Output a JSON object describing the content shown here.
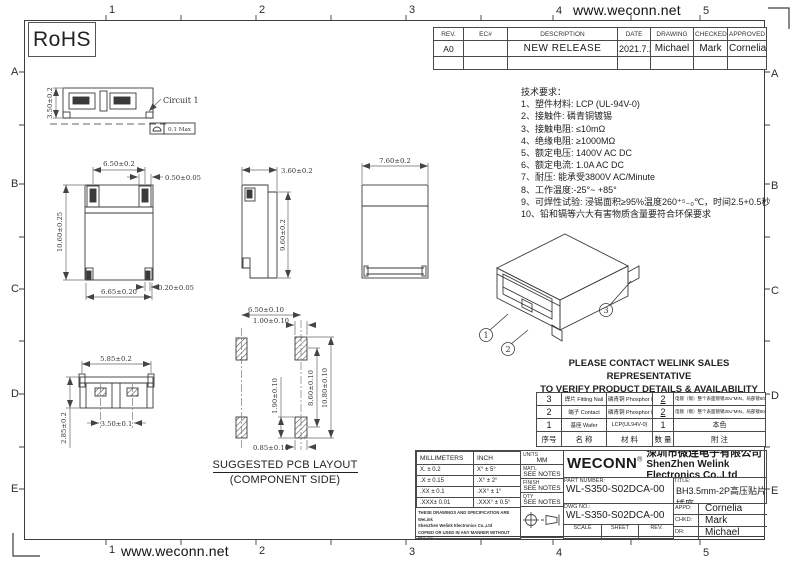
{
  "sheet": {
    "top_url": "www.weconn.net",
    "bottom_url": "www.weconn.net",
    "rohs_label": "RoHS",
    "grid_cols": [
      "1",
      "2",
      "3",
      "4",
      "5"
    ],
    "grid_rows": [
      "A",
      "B",
      "C",
      "D",
      "E"
    ]
  },
  "revision_table": {
    "headers": [
      "REV.",
      "EC#",
      "DESCRIPTION",
      "DATE",
      "DRAWING",
      "CHECKED",
      "APPROVED"
    ],
    "row": {
      "rev": "A0",
      "ec": "",
      "description": "NEW RELEASE",
      "date": "2021.7.25",
      "drawing": "Michael",
      "checked": "Mark",
      "approved": "Cornelia"
    }
  },
  "tech_notes": {
    "title": "技术要求：",
    "items": [
      "1、塑件材料: LCP (UL-94V-0)",
      "2、接触件: 磷青铜镀锡",
      "3、接触电阻: ≤10mΩ",
      "4、绝缘电阻: ≥1000MΩ",
      "5、额定电压: 1400V AC DC",
      "6、额定电流: 1.0A AC DC",
      "7、耐压: 能承受3800V  AC/Minute",
      "8、工作温度:-25°~ +85°",
      "9、可焊性试验: 浸锡面积≥95%温度260⁺⁵₋₀℃，时间2.5+0.5秒",
      "10、铅和镉等六大有害物质含量要符合环保要求"
    ]
  },
  "views": {
    "front": {
      "height_dim": "3.50±0.2",
      "circuit_label": "Circuit 1",
      "flatness_value": "0.1 Max"
    },
    "top": {
      "width_top": "6.50±0.2",
      "nail_width": "0.50±0.05",
      "height": "10.60±0.25",
      "pad_width": "0.20±0.05",
      "width_bottom": "6.65±0.20"
    },
    "side": {
      "width": "3.60±0.2",
      "height": "9.60±0.2"
    },
    "rear": {
      "width": "7.60±0.2"
    },
    "bottom": {
      "width": "5.85±0.2",
      "height": "2.85±0.2",
      "pitch": "3.50±0.1"
    },
    "pcb": {
      "pitch": "6.50±0.10",
      "pad_w_top": "1.00±0.10",
      "pad_len": "1.90±0.10",
      "span_inner": "8.60±0.10",
      "span_outer": "10.80±0.10",
      "pad_w_bottom": "0.85±0.10",
      "caption_line1": "SUGGESTED PCB LAYOUT",
      "caption_line2": "(COMPONENT SIDE)"
    },
    "iso": {
      "balloons": [
        "1",
        "2",
        "3"
      ]
    }
  },
  "notice": {
    "line1": "PLEASE CONTACT WELINK SALES REPRESENTATIVE",
    "line2": "TO VERIFY PRODUCT DETAILS & AVAILABILITY"
  },
  "bom_table": {
    "rows": [
      {
        "no": "3",
        "name": "焊片 Fitting Nail",
        "material": "磷青铜 Phosphor Bronze",
        "qty": "2",
        "remark": "电镀（锡）整个表面镀锡30u″MIN，局部镀80u″MIN"
      },
      {
        "no": "2",
        "name": "端子 Contact",
        "material": "磷青铜 Phosphor Bronze",
        "qty": "2",
        "remark": "电镀（锡）整个表面镀锡30u″MIN，局部镀80u″MIN"
      },
      {
        "no": "1",
        "name": "基座 Wafer",
        "material": "LCP(UL94V-0)",
        "qty": "1",
        "remark": "本色"
      }
    ],
    "footer": {
      "no": "序号",
      "name": "名  称",
      "material": "材  料",
      "qty": "数  量",
      "remark": "附  注"
    }
  },
  "title_block": {
    "tolerance": {
      "col_mm": "MILLIMETERS",
      "col_inch": "INCH",
      "rows": [
        [
          "X.  ± 0.2",
          "X°  ± 5°"
        ],
        [
          ".X  ± 0.15",
          ".X°  ± 2°"
        ],
        [
          ".XX ± 0.1",
          ".XX° ± 1°"
        ],
        [
          ".XXX± 0.01",
          ".XXX° ± 0.5°"
        ]
      ]
    },
    "units_label": "UNITS",
    "units_value": "MM",
    "matl_label": "MAT'L",
    "matl_value": "SEE NOTES",
    "finish_label": "FINISH",
    "finish_value": "SEE NOTES",
    "qty_label": "QTY",
    "qty_value": "SEE NOTES",
    "disclaimer": [
      "THESE DRAWINGS AND SPECIFICATION ARE WeLink",
      "ShenZhen Welink Electronics Co.,Ltd",
      "COPIED OR USED IN ANY MANNER WITHOUT WeLink",
      "ShenZhen Welink Electronics Co.,Ltd"
    ],
    "brand": "WECONN",
    "brand_reg": "®",
    "company_cn": "深圳市微连电子有限公司",
    "company_en": "ShenZhen Welink Electronics Co.,Ltd",
    "part_number_label": "PART NUMBER:",
    "part_number": "WL-S350-S02DCA-00",
    "title_label": "TITLE:",
    "title": "BH3.5mm-2P高压贴片插座",
    "dwg_label": "DWG NO.:",
    "dwg_no": "WL-S350-S02DCA-00",
    "scale_label": "SCALE",
    "scale": "1:1",
    "sheet_label": "SHEET",
    "sheet": "1/1",
    "rev_label": "REV.",
    "rev": "A1",
    "appd_label": "APPD:",
    "appd": "Cornelia",
    "chkd_label": "CHKD:",
    "chkd": "Mark",
    "dr_label": "DR:",
    "dr": "Michael"
  }
}
